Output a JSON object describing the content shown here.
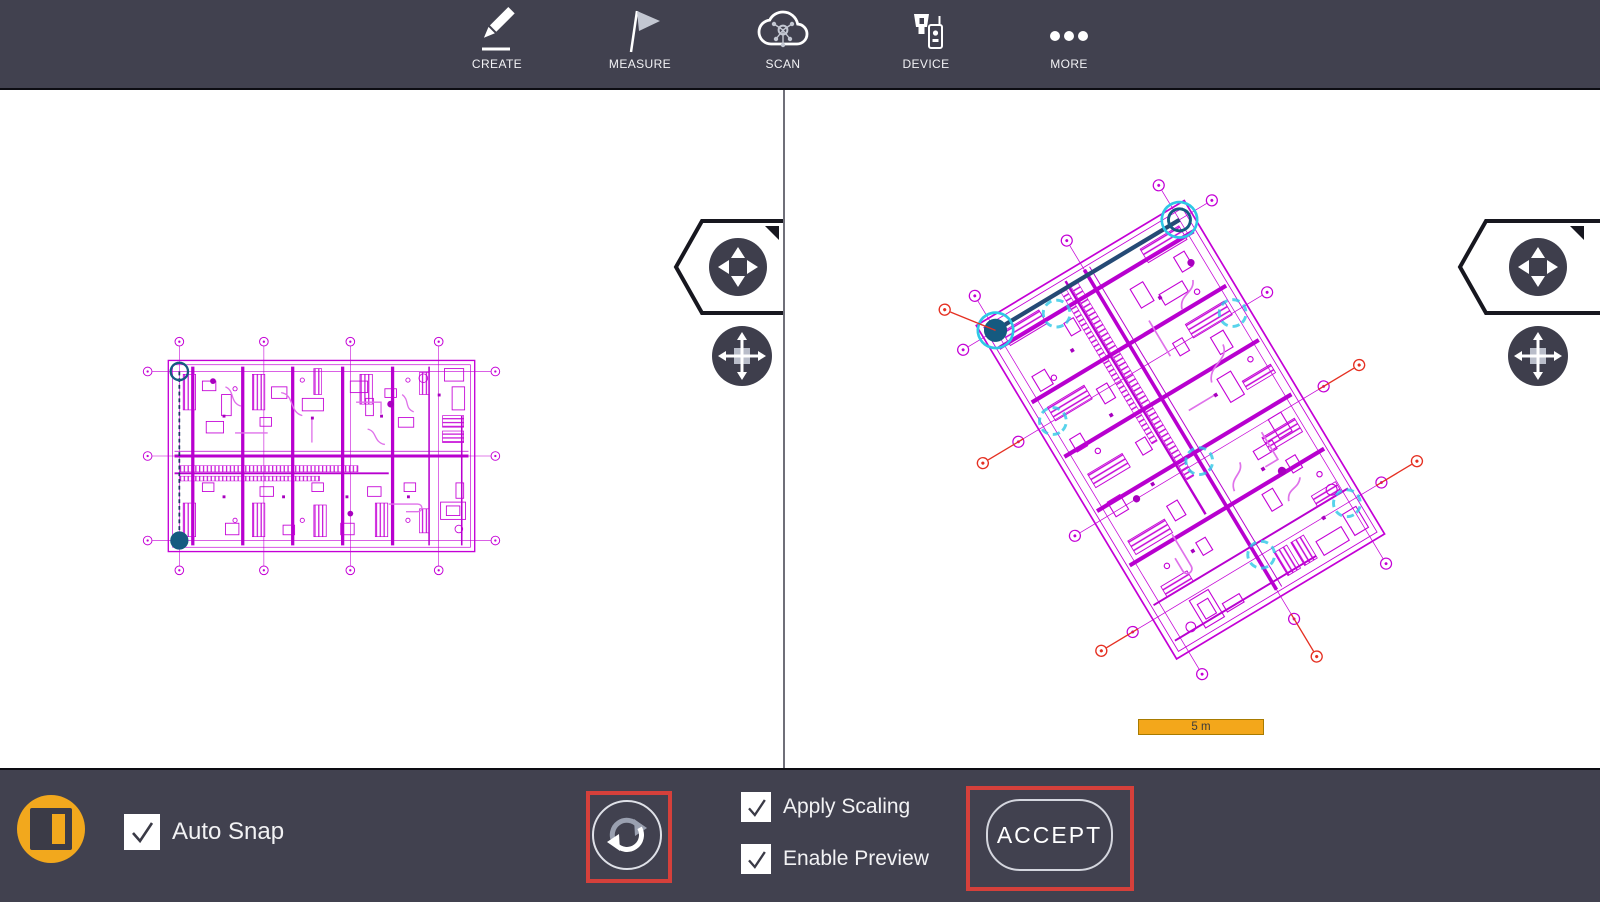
{
  "toolbar": {
    "items": [
      {
        "id": "create",
        "label": "CREATE",
        "icon": "pencil-icon"
      },
      {
        "id": "measure",
        "label": "MEASURE",
        "icon": "flag-icon"
      },
      {
        "id": "scan",
        "label": "SCAN",
        "icon": "cloud-scan-icon"
      },
      {
        "id": "device",
        "label": "DEVICE",
        "icon": "device-icon"
      },
      {
        "id": "more",
        "label": "MORE",
        "icon": "ellipsis-icon"
      }
    ]
  },
  "left_viewport": {
    "scale_bar_label": "10 m",
    "icons": [
      "pan-flyout-icon",
      "move-icon",
      "cancel-icon"
    ]
  },
  "right_viewport": {
    "scale_bar_label": "5 m",
    "icons": [
      "pan-flyout-icon",
      "move-icon",
      "cancel-icon"
    ]
  },
  "bottom_bar": {
    "split_view_button_icon": "split-view-icon",
    "auto_snap_label": "Auto Snap",
    "auto_snap_checked": true,
    "rotate_button_icon": "rotate-sync-icon",
    "apply_scaling_label": "Apply Scaling",
    "apply_scaling_checked": true,
    "enable_preview_label": "Enable Preview",
    "enable_preview_checked": true,
    "accept_label": "ACCEPT"
  },
  "colors": {
    "bar_background": "#41414f",
    "accent_yellow": "#f2a81d",
    "highlight_red": "#d5403b",
    "plan_magenta": "#c400d6",
    "plan_deep_magenta": "#a800bf",
    "anchor_navy": "#155a80",
    "cyan_highlight": "#2ec8e6",
    "scale_bar_yellow": "#f3a71b"
  }
}
